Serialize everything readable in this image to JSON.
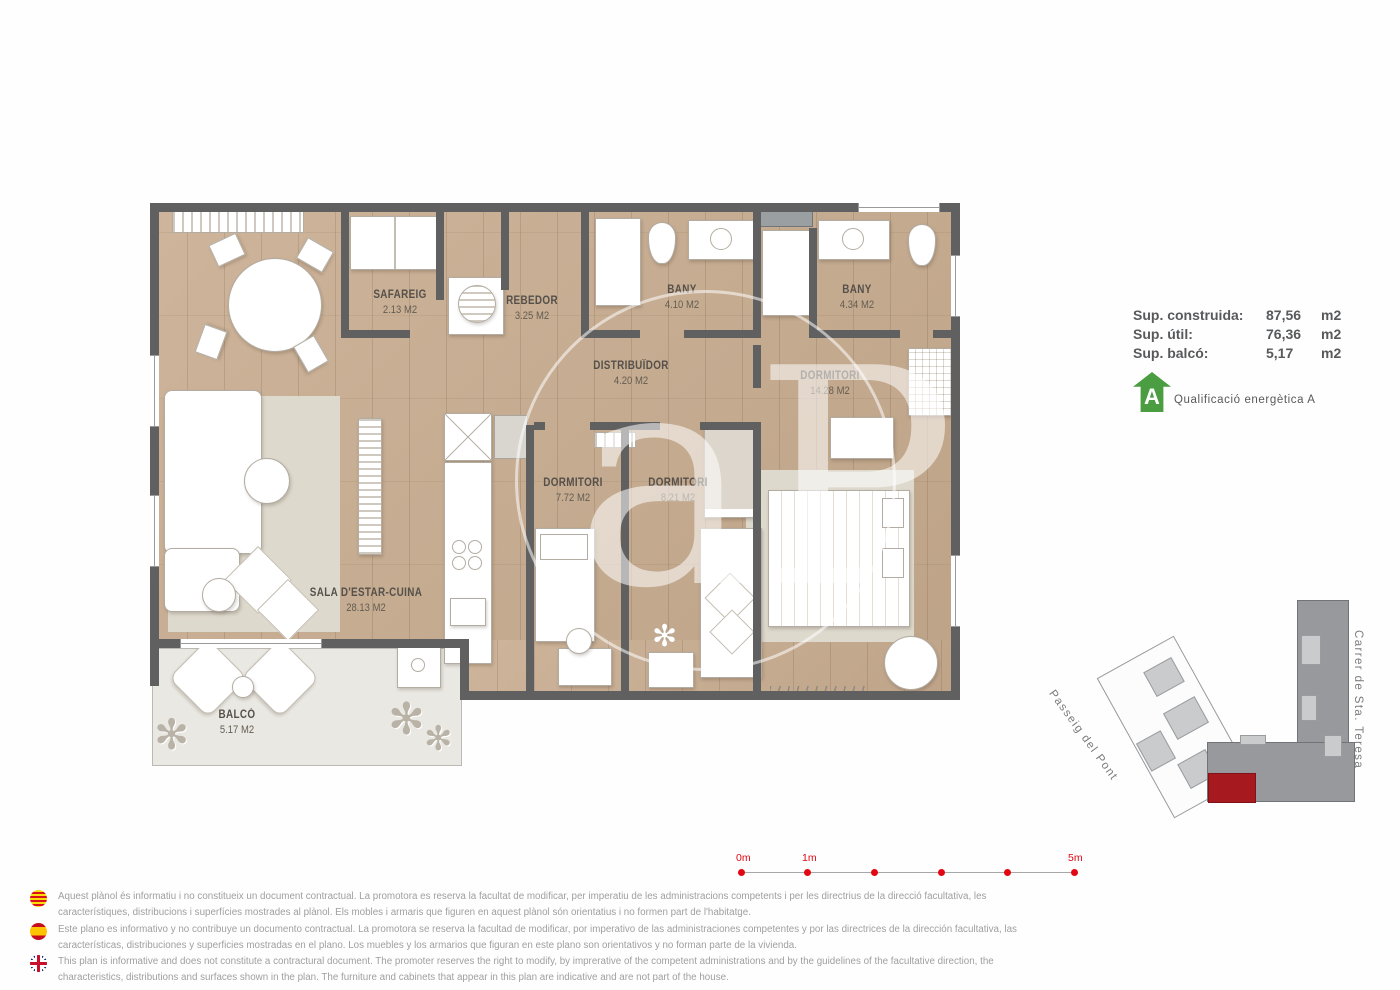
{
  "plan": {
    "rooms": [
      {
        "name": "SAFAREIG",
        "area": "2.13 M2"
      },
      {
        "name": "REBEDOR",
        "area": "3.25 M2"
      },
      {
        "name": "BANY",
        "area": "4.10 M2"
      },
      {
        "name": "BANY",
        "area": "4.34 M2"
      },
      {
        "name": "DISTRIBUÏDOR",
        "area": "4.20 M2"
      },
      {
        "name": "DORMITORI",
        "area": "14.28 M2"
      },
      {
        "name": "DORMITORI",
        "area": "7.72 M2"
      },
      {
        "name": "DORMITORI",
        "area": "8.21 M2"
      },
      {
        "name": "SALA D'ESTAR-CUINA",
        "area": "28.13 M2"
      },
      {
        "name": "BALCÓ",
        "area": "5.17 M2"
      }
    ],
    "watermark": "aP"
  },
  "summary": {
    "rows": [
      {
        "label": "Sup. construida:",
        "value": "87,56",
        "unit": "m2"
      },
      {
        "label": "Sup. útil:",
        "value": "76,36",
        "unit": "m2"
      },
      {
        "label": "Sup. balcó:",
        "value": "5,17",
        "unit": "m2"
      }
    ],
    "energy": {
      "rating": "A",
      "label": "Qualificació energètica A",
      "color": "#4a9e41"
    }
  },
  "sitemap": {
    "street_left": "Passeig del Pont",
    "street_right": "Carrer de Sta. Teresa",
    "highlight_color": "#a6191e"
  },
  "scalebar": {
    "labels": [
      "0m",
      "1m",
      "5m"
    ],
    "color": "#e30613"
  },
  "disclaimers": [
    {
      "lang": "catalan",
      "text": "Aquest plànol és informatiu i no constitueix un document contractual. La promotora es reserva la facultat de modificar, per imperatiu de les administracions competents i per les directrius de la direcció facultativa, les característiques, distribucions i superfícies mostrades al plànol. Els mobles i armaris que figuren en aquest plànol són orientatius i no formen part de l'habitatge."
    },
    {
      "lang": "spanish",
      "text": "Este plano es informativo y no contribuye un documento contractual. La promotora se reserva la facultad de modificar, por imperativo de las administraciones competentes y por las directrices de la dirección facultativa, las características, distribuciones y superficies mostradas en el plano. Los muebles y los armarios que figuran en este plano son orientativos y no forman parte de la vivienda."
    },
    {
      "lang": "english",
      "text": "This plan is informative and does not constitute a contractural document. The promoter reserves the right to modify, by imprerative of the competent administrations and by the guidelines of the facultative direction, the characteristics, distributions and surfaces shown in the plan. The furniture and cabinets that appear in this plan are indicative and are not part of the house."
    }
  ]
}
